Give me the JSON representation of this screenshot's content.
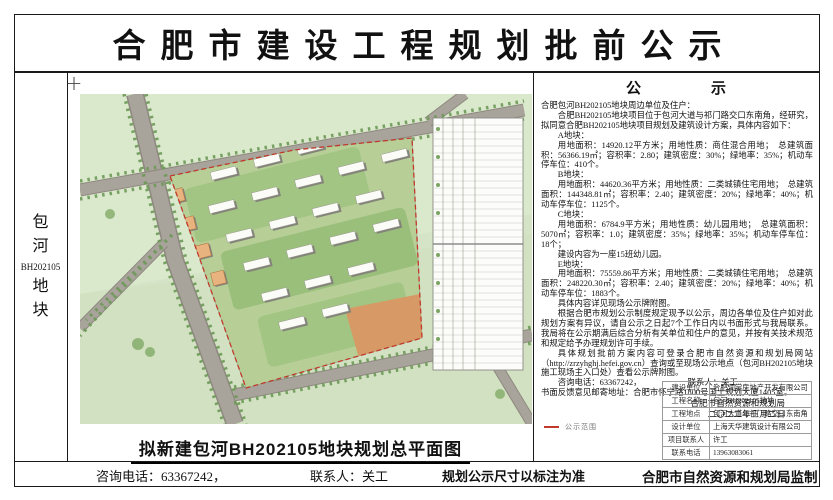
{
  "page": {
    "title": "合肥市建设工程规划批前公示"
  },
  "sidebar": {
    "char1": "包",
    "char2": "河",
    "code": "BH202105",
    "char3": "地",
    "char4": "块"
  },
  "map": {
    "caption": "拟新建包河BH202105地块规划总平面图",
    "legend_boundary_label": "公示范围"
  },
  "colors": {
    "boundary_red": "#c0392b",
    "map_green": "#d5e4c6",
    "road_gray": "#a8a39b"
  },
  "notice": {
    "heading": "公　　　　示",
    "paragraphs": [
      "合肥包河BH202105地块周边单位及住户：",
      "合肥BH202105地块项目位于包河大道与祁门路交口东南角，经研究，拟同意合肥BH202105地块项目规划及建筑设计方案，具体内容如下：",
      "A地块：",
      "用地面积：14920.12平方米；用地性质：商住混合用地；　总建筑面积：56366.19㎡；容积率：2.80；建筑密度：30%；绿地率：35%；机动车停车位：410个。",
      "B地块：",
      "用地面积：44620.36平方米；用地性质：二类城镇住宅用地；　总建筑面积：144348.81㎡；容积率：2.40；建筑密度：20%；绿地率：40%；机动车停车位：1125个。",
      "C地块：",
      "用地面积：6784.9平方米；用地性质：幼儿园用地；　总建筑面积：5070㎡；容积率：1.0；建筑密度：35%；绿地率：35%；机动车停车位：18个；",
      "建设内容为一座15班幼儿园。",
      "E地块：",
      "用地面积：75559.86平方米；用地性质：二类城镇住宅用地；　总建筑面积：248220.30㎡；容积率：2.40；建筑密度：20%；绿地率：40%；机动车停车位：1883个。",
      "具体内容详见现场公示牌附图。",
      "根据合肥市规划公示制度规定现予以公示，周边各单位及住户如对此规划方案有异议，请自公示之日起7个工作日内以书面形式与我局联系。我局将在公示期满后综合分析有关单位和住户的意见，并按有关技术规范和规定给予办理规划许可手续。",
      "具体规划批前方案内容可登录合肥市自然资源和规划局网站（http://zrzyhghj.hefei.gov.cn）查询或至现场公示地点（包河BH202105地块施工现场主入口处）查看公示牌附图。",
      "咨询电话：63367242，　　　　　　联系人：关工",
      "书面反馈意见邮寄地址：合肥市怀宁路1800号国土规划大厦1405室。"
    ],
    "signature": [
      "合肥市自然资源和规划局",
      "二〇二二年三月二日"
    ]
  },
  "info_table": {
    "rows": [
      {
        "label": "建设单位",
        "value": "合肥润棠房地产开发有限公司"
      },
      {
        "label": "工程名称",
        "value": "包河BH202105地块"
      },
      {
        "label": "工程地点",
        "value": "包河大道与祁门路交口东南角"
      },
      {
        "label": "设计单位",
        "value": "上海天华建筑设计有限公司"
      },
      {
        "label": "项目联系人",
        "value": "许工"
      },
      {
        "label": "联系电话",
        "value": "13963083061"
      }
    ]
  },
  "footer": {
    "phone": "咨询电话：63367242，",
    "contact": "联系人：关工",
    "note": "规划公示尺寸以标注为准",
    "issuer": "合肥市自然资源和规划局监制"
  }
}
